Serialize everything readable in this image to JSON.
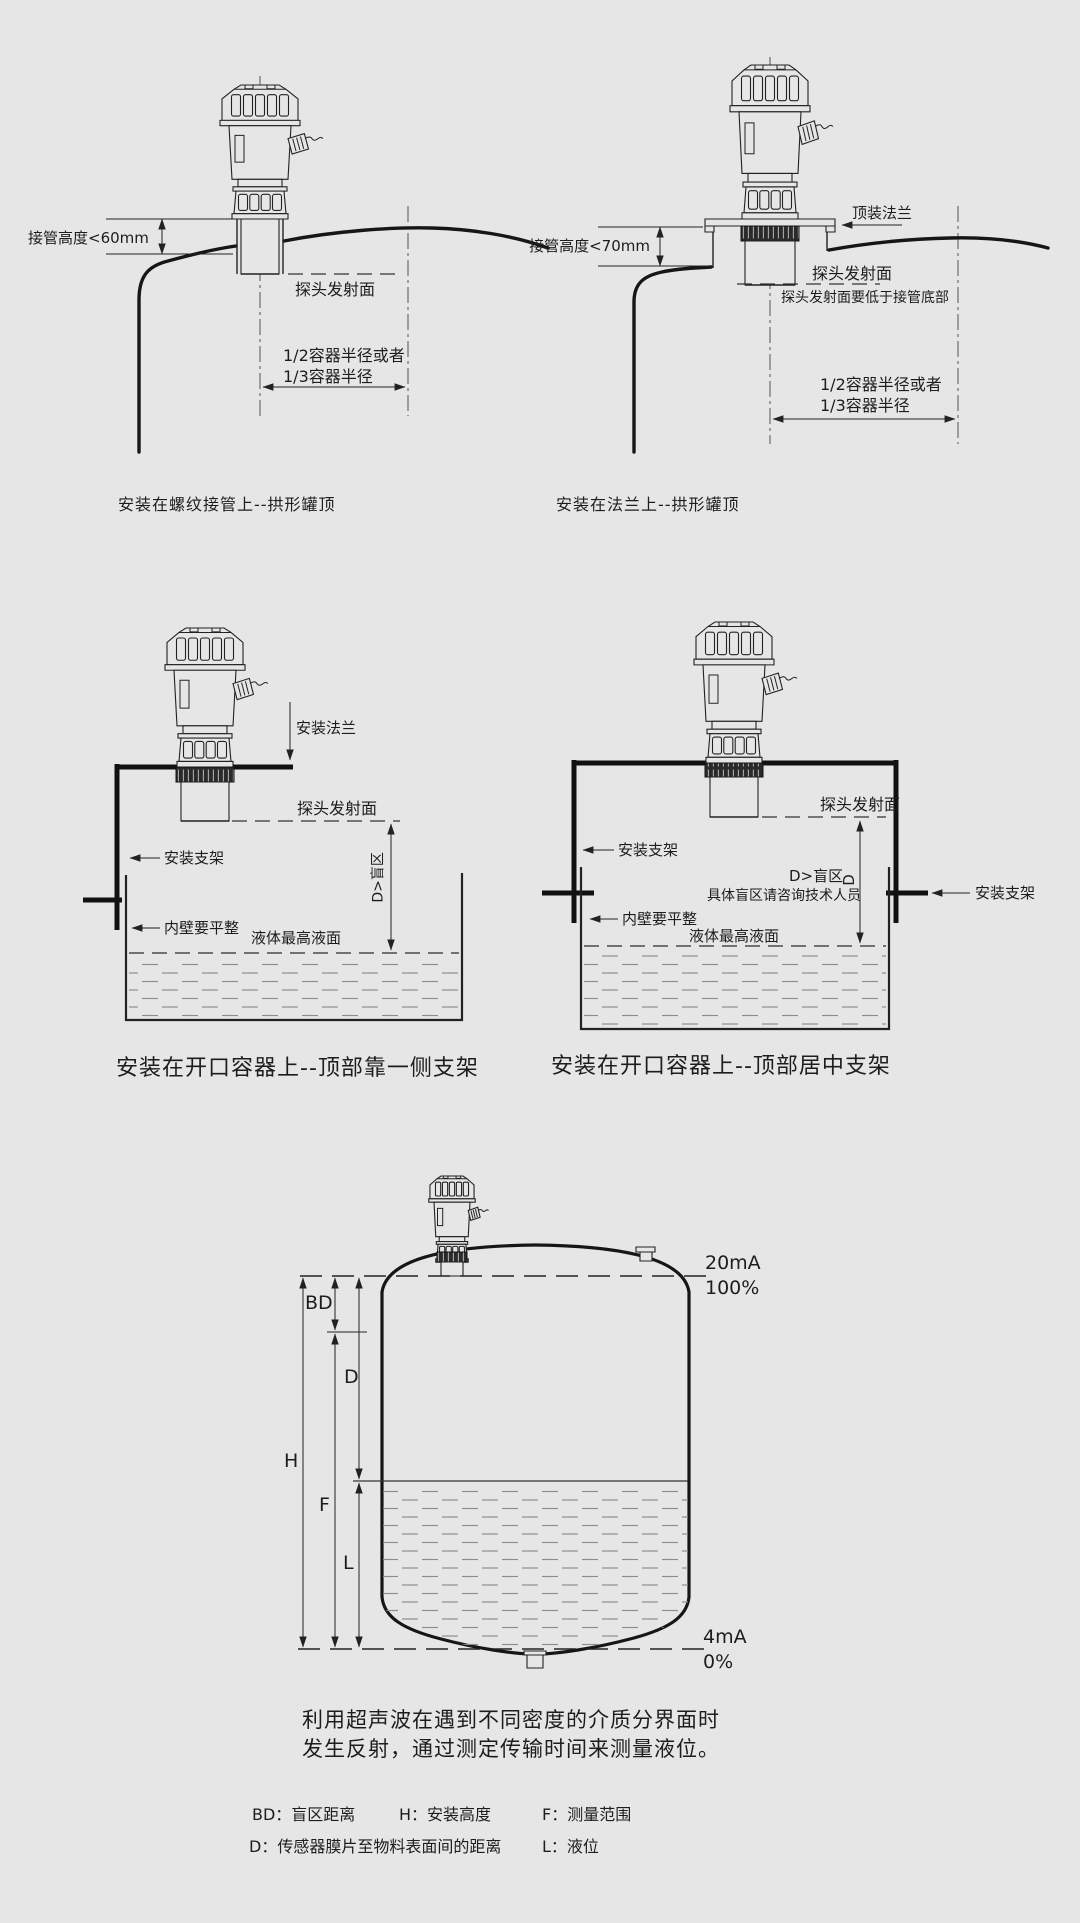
{
  "page": {
    "bg": "#e6e6e6",
    "line_color": "#1c1c1c"
  },
  "d1": {
    "caption": "安装在螺纹接管上--拱形罐顶",
    "pipe_height": "接管高度<60mm",
    "probe_surface": "探头发射面",
    "radius1": "1/2容器半径或者",
    "radius2": "1/3容器半径"
  },
  "d2": {
    "caption": "安装在法兰上--拱形罐顶",
    "pipe_height": "接管高度<70mm",
    "top_flange": "顶装法兰",
    "probe_surface": "探头发射面",
    "probe_note": "探头发射面要低于接管底部",
    "radius1": "1/2容器半径或者",
    "radius2": "1/3容器半径"
  },
  "d3": {
    "caption": "安装在开口容器上--顶部靠一侧支架",
    "mount_flange": "安装法兰",
    "probe_surface": "探头发射面",
    "bracket": "安装支架",
    "wall": "内壁要平整",
    "max_level": "液体最高液面",
    "blind": "D>盲区"
  },
  "d4": {
    "caption": "安装在开口容器上--顶部居中支架",
    "probe_surface": "探头发射面",
    "bracket_left": "安装支架",
    "bracket_right": "安装支架",
    "wall": "内壁要平整",
    "max_level": "液体最高液面",
    "blind": "D>盲区",
    "blind_letter": "D",
    "blind_note": "具体盲区请咨询技术人员"
  },
  "d5": {
    "bd": "BD",
    "d": "D",
    "h": "H",
    "f": "F",
    "l": "L",
    "top_current": "20mA",
    "top_percent": "100%",
    "bottom_current": "4mA",
    "bottom_percent": "0%"
  },
  "description": {
    "line1": "利用超声波在遇到不同密度的介质分界面时",
    "line2": "发生反射，通过测定传输时间来测量液位。"
  },
  "legend": {
    "bd": "BD：盲区距离",
    "h": "H：安装高度",
    "f": "F：测量范围",
    "d": "D：传感器膜片至物料表面间的距离",
    "l": "L：液位"
  }
}
